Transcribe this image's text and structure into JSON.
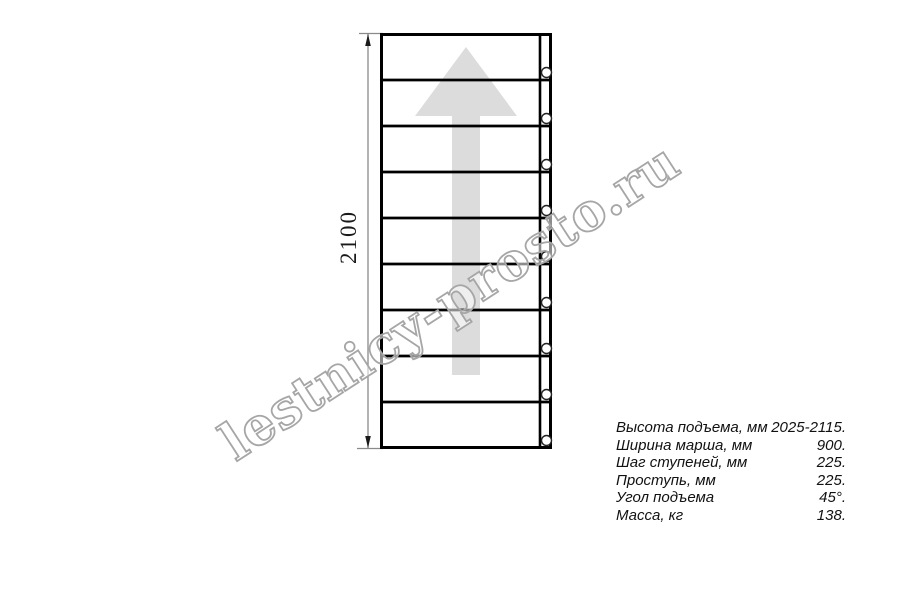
{
  "watermark": {
    "text": "lestnicy-prosto.ru",
    "outline_color": "#a6a6a6"
  },
  "dimension": {
    "label": "2100"
  },
  "diagram": {
    "steps": 9,
    "bolts": 9,
    "line_color": "#000000",
    "arrow_color": "#dcdcdc",
    "dimension_color": "#8a8a8a",
    "bolt_stroke_color": "#222222"
  },
  "specs": {
    "rows": [
      {
        "label": "Высота подъема, мм",
        "value": "2025-2115."
      },
      {
        "label": "Ширина марша, мм",
        "value": "900."
      },
      {
        "label": "Шаг ступеней, мм",
        "value": "225."
      },
      {
        "label": "Проступь, мм",
        "value": "225."
      },
      {
        "label": "Угол подъема",
        "value": "45°."
      },
      {
        "label": "Масса, кг",
        "value": "138."
      }
    ]
  }
}
